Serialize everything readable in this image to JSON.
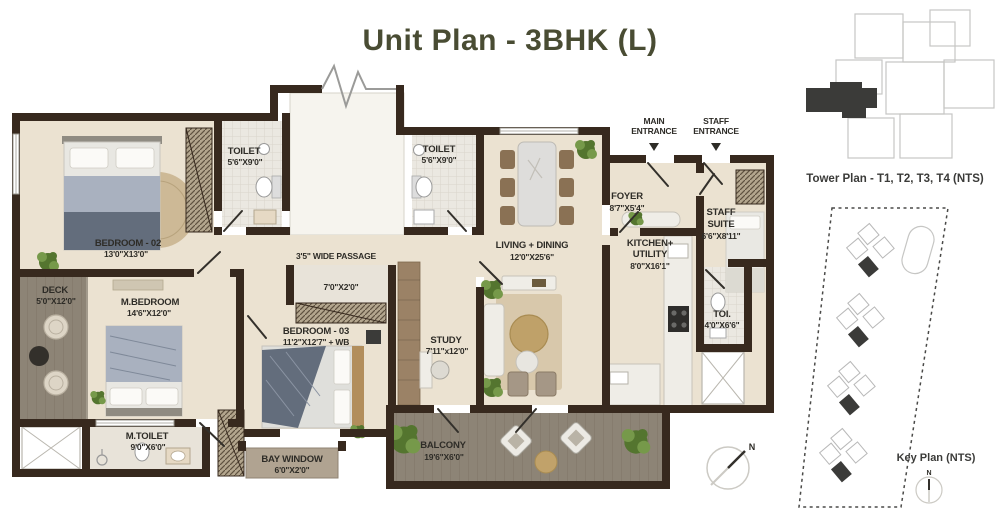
{
  "title": "Unit Plan - 3BHK (L)",
  "plan": {
    "rooms": [
      {
        "id": "bedroom-02",
        "name": "BEDROOM - 02",
        "dim": "13'0\"X13'0\""
      },
      {
        "id": "toilet-1",
        "name": "TOILET",
        "dim": "5'6\"X9'0\""
      },
      {
        "id": "toilet-2",
        "name": "TOILET",
        "dim": "5'6\"X9'0\""
      },
      {
        "id": "living-dining",
        "name": "LIVING + DINING",
        "dim": "12'0\"X25'6\""
      },
      {
        "id": "foyer",
        "name": "FOYER",
        "dim": "8'7\"X5'4\""
      },
      {
        "id": "staff-suite",
        "name": "STAFF",
        "name2": "SUITE",
        "dim": "6'6\"X8'11\""
      },
      {
        "id": "kitchen-utility",
        "name": "KITCHEN+",
        "name2": "UTILITY",
        "dim": "8'0\"X16'1\""
      },
      {
        "id": "toi",
        "name": "TOI.",
        "dim": "4'0\"X6'6\""
      },
      {
        "id": "deck",
        "name": "DECK",
        "dim": "5'0\"X12'0\""
      },
      {
        "id": "m-bedroom",
        "name": "M.BEDROOM",
        "dim": "14'6\"X12'0\""
      },
      {
        "id": "bedroom-03",
        "name": "BEDROOM - 03",
        "dim": "11'2\"X12'7\" + WB"
      },
      {
        "id": "study",
        "name": "STUDY",
        "dim": "7'11\"x12'0\""
      },
      {
        "id": "m-toilet",
        "name": "M.TOILET",
        "dim": "9'0\"X6'0\""
      },
      {
        "id": "bay-window",
        "name": "BAY WINDOW",
        "dim": "6'0\"X2'0\""
      },
      {
        "id": "balcony",
        "name": "BALCONY",
        "dim": "19'6\"X6'0\""
      }
    ],
    "annotations": {
      "passage": "3'5\" WIDE PASSAGE",
      "niche_dim": "7'0\"X2'0\""
    },
    "entrances": [
      {
        "name": "MAIN",
        "name2": "ENTRANCE"
      },
      {
        "name": "STAFF",
        "name2": "ENTRANCE"
      }
    ],
    "compass": {
      "north": "N"
    }
  },
  "side_panel": {
    "tower_caption": "Tower Plan - T1, T2, T3, T4 (NTS)",
    "key_caption": "Key Plan (NTS)",
    "north": "N"
  },
  "colors": {
    "wall": "#37291e",
    "floor": "#ebe2d1",
    "floor2": "#f6f4ee",
    "marble": "#e8e3d9",
    "tile": "#ebe8e1",
    "wood": "#8d8476",
    "bay": "#b0a391",
    "hatch_bg": "#b3a68e",
    "hatch_line": "#5e5140",
    "rug": "#c8b28c",
    "green": "#54752f",
    "green2": "#76994a",
    "bed_light": "#a9b1bf",
    "bed_dark": "#636d7c",
    "furn": "#efede7",
    "ink": "#2e2c27",
    "title": "#494c33",
    "dark": "#3b3b39"
  }
}
